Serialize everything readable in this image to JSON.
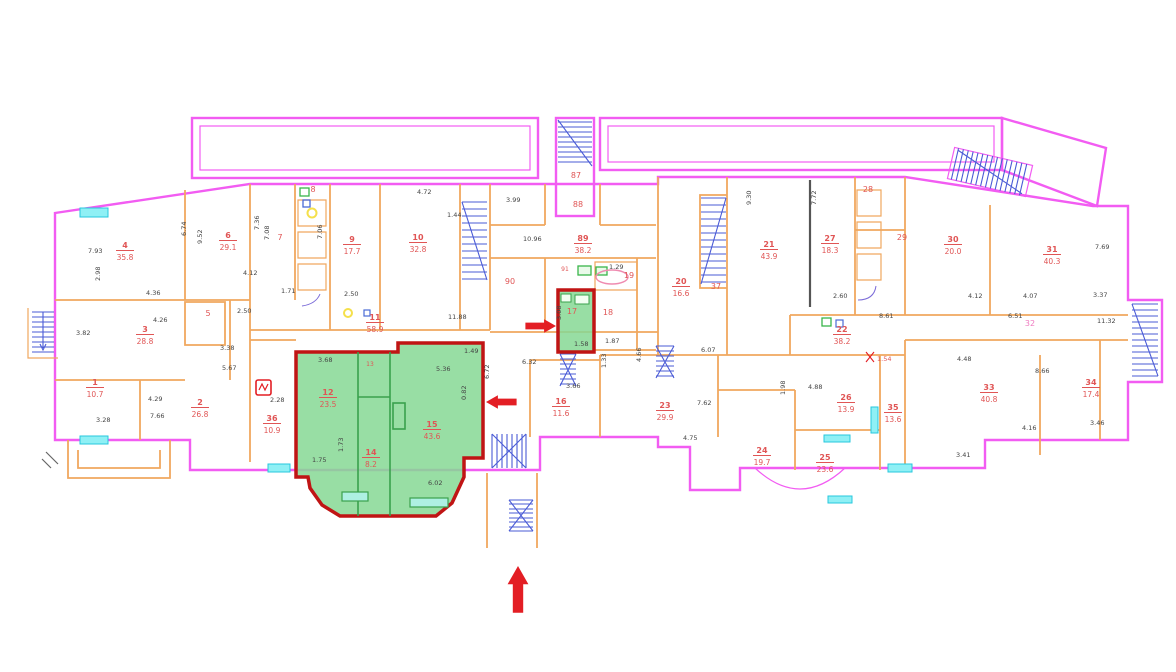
{
  "title": "building-floor-plan",
  "colors": {
    "wall_outer": "#f25cf2",
    "wall_inner": "#f0a85f",
    "stair": "#4a5bd6",
    "window": "#8ff0f5",
    "window_border": "#27c7dd",
    "highlight_fill": "#86d894",
    "highlight_border": "#c01414",
    "room_label": "#e05555",
    "corridor_label": "#ef7bc0",
    "dim_text": "#444444",
    "arrow": "#e31e24",
    "black_wall": "#555555",
    "fixture_green": "#39b54a",
    "fixture_yellow": "#f5e04b",
    "fixture_blue": "#4a6bd6",
    "bath_pink": "#ef8bb0"
  },
  "highlights": {
    "large_unit_rooms": [
      "12",
      "14",
      "15"
    ],
    "small_unit_room": "17"
  },
  "rooms": [
    {
      "num": "1",
      "area": "10.7",
      "x": 95,
      "y": 385
    },
    {
      "num": "2",
      "area": "26.8",
      "x": 200,
      "y": 405
    },
    {
      "num": "3",
      "area": "28.8",
      "x": 145,
      "y": 332
    },
    {
      "num": "4",
      "area": "35.8",
      "x": 125,
      "y": 248
    },
    {
      "num": "6",
      "area": "29.1",
      "x": 228,
      "y": 238
    },
    {
      "num": "9",
      "area": "17.7",
      "x": 352,
      "y": 242
    },
    {
      "num": "10",
      "area": "32.8",
      "x": 418,
      "y": 240
    },
    {
      "num": "11",
      "area": "58.9",
      "x": 375,
      "y": 320
    },
    {
      "num": "12",
      "area": "23.5",
      "x": 328,
      "y": 395
    },
    {
      "num": "14",
      "area": "8.2",
      "x": 371,
      "y": 455
    },
    {
      "num": "15",
      "area": "43.6",
      "x": 432,
      "y": 427
    },
    {
      "num": "16",
      "area": "11.6",
      "x": 561,
      "y": 404
    },
    {
      "num": "20",
      "area": "16.6",
      "x": 681,
      "y": 284
    },
    {
      "num": "21",
      "area": "43.9",
      "x": 769,
      "y": 247
    },
    {
      "num": "22",
      "area": "38.2",
      "x": 842,
      "y": 332
    },
    {
      "num": "23",
      "area": "29.9",
      "x": 665,
      "y": 408
    },
    {
      "num": "24",
      "area": "19.7",
      "x": 762,
      "y": 453
    },
    {
      "num": "25",
      "area": "23.6",
      "x": 825,
      "y": 460
    },
    {
      "num": "26",
      "area": "13.9",
      "x": 846,
      "y": 400
    },
    {
      "num": "27",
      "area": "18.3",
      "x": 830,
      "y": 241
    },
    {
      "num": "30",
      "area": "20.0",
      "x": 953,
      "y": 242
    },
    {
      "num": "31",
      "area": "40.3",
      "x": 1052,
      "y": 252
    },
    {
      "num": "33",
      "area": "40.8",
      "x": 989,
      "y": 390
    },
    {
      "num": "34",
      "area": "17.4",
      "x": 1091,
      "y": 385
    },
    {
      "num": "35",
      "area": "13.6",
      "x": 893,
      "y": 410
    },
    {
      "num": "36",
      "area": "10.9",
      "x": 272,
      "y": 421
    },
    {
      "num": "89",
      "area": "38.2",
      "x": 583,
      "y": 241
    }
  ],
  "labels": [
    {
      "t": "5",
      "x": 208,
      "y": 316
    },
    {
      "t": "7",
      "x": 280,
      "y": 240
    },
    {
      "t": "8",
      "x": 313,
      "y": 192
    },
    {
      "t": "13",
      "x": 370,
      "y": 366,
      "c": "small"
    },
    {
      "t": "17",
      "x": 572,
      "y": 314
    },
    {
      "t": "18",
      "x": 608,
      "y": 315
    },
    {
      "t": "19",
      "x": 629,
      "y": 278
    },
    {
      "t": "28",
      "x": 868,
      "y": 192
    },
    {
      "t": "29",
      "x": 902,
      "y": 240
    },
    {
      "t": "37",
      "x": 716,
      "y": 289
    },
    {
      "t": "87",
      "x": 576,
      "y": 178
    },
    {
      "t": "88",
      "x": 578,
      "y": 207
    },
    {
      "t": "90",
      "x": 510,
      "y": 284
    },
    {
      "t": "91",
      "x": 565,
      "y": 271,
      "c": "small"
    },
    {
      "t": "32",
      "x": 1030,
      "y": 326,
      "c": "pink"
    }
  ],
  "dimensions": [
    {
      "t": "7.93",
      "x": 88,
      "y": 253
    },
    {
      "t": "2.98",
      "x": 100,
      "y": 281,
      "v": true
    },
    {
      "t": "6.74",
      "x": 186,
      "y": 236,
      "v": true
    },
    {
      "t": "9.52",
      "x": 202,
      "y": 244,
      "v": true
    },
    {
      "t": "4.36",
      "x": 146,
      "y": 295
    },
    {
      "t": "4.26",
      "x": 153,
      "y": 322
    },
    {
      "t": "3.82",
      "x": 76,
      "y": 335
    },
    {
      "t": "4.12",
      "x": 243,
      "y": 275
    },
    {
      "t": "1.71",
      "x": 281,
      "y": 293
    },
    {
      "t": "2.50",
      "x": 237,
      "y": 313
    },
    {
      "t": "3.38",
      "x": 220,
      "y": 350
    },
    {
      "t": "5.67",
      "x": 222,
      "y": 370
    },
    {
      "t": "4.29",
      "x": 148,
      "y": 401
    },
    {
      "t": "7.66",
      "x": 150,
      "y": 418
    },
    {
      "t": "2.28",
      "x": 270,
      "y": 402
    },
    {
      "t": "3.28",
      "x": 96,
      "y": 422
    },
    {
      "t": "7.36",
      "x": 259,
      "y": 230,
      "v": true
    },
    {
      "t": "7.08",
      "x": 269,
      "y": 240,
      "v": true
    },
    {
      "t": "7.06",
      "x": 322,
      "y": 239,
      "v": true
    },
    {
      "t": "4.72",
      "x": 417,
      "y": 194
    },
    {
      "t": "2.50",
      "x": 344,
      "y": 296
    },
    {
      "t": "11.88",
      "x": 448,
      "y": 319
    },
    {
      "t": "3.99",
      "x": 506,
      "y": 202
    },
    {
      "t": "1.44",
      "x": 447,
      "y": 217
    },
    {
      "t": "10.96",
      "x": 523,
      "y": 241
    },
    {
      "t": "1.29",
      "x": 609,
      "y": 269
    },
    {
      "t": "3.68",
      "x": 318,
      "y": 362
    },
    {
      "t": "5.36",
      "x": 436,
      "y": 371
    },
    {
      "t": "1.49",
      "x": 464,
      "y": 353
    },
    {
      "t": "6.72",
      "x": 489,
      "y": 379,
      "v": true
    },
    {
      "t": "0.82",
      "x": 466,
      "y": 400,
      "v": true
    },
    {
      "t": "6.02",
      "x": 428,
      "y": 485
    },
    {
      "t": "1.75",
      "x": 312,
      "y": 462
    },
    {
      "t": "1.73",
      "x": 343,
      "y": 452,
      "v": true
    },
    {
      "t": "3.08",
      "x": 561,
      "y": 320,
      "v": true
    },
    {
      "t": "1.58",
      "x": 574,
      "y": 346
    },
    {
      "t": "1.87",
      "x": 605,
      "y": 343
    },
    {
      "t": "6.32",
      "x": 522,
      "y": 364
    },
    {
      "t": "3.66",
      "x": 566,
      "y": 388
    },
    {
      "t": "1.33",
      "x": 606,
      "y": 368,
      "v": true
    },
    {
      "t": "4.66",
      "x": 641,
      "y": 362,
      "v": true
    },
    {
      "t": "6.07",
      "x": 701,
      "y": 352
    },
    {
      "t": "7.62",
      "x": 697,
      "y": 405
    },
    {
      "t": "4.75",
      "x": 683,
      "y": 440
    },
    {
      "t": "9.30",
      "x": 751,
      "y": 205,
      "v": true
    },
    {
      "t": "7.72",
      "x": 816,
      "y": 205,
      "v": true
    },
    {
      "t": "2.60",
      "x": 833,
      "y": 298
    },
    {
      "t": "8.61",
      "x": 879,
      "y": 318
    },
    {
      "t": "6.51",
      "x": 1008,
      "y": 318
    },
    {
      "t": "4.88",
      "x": 808,
      "y": 389
    },
    {
      "t": "1.98",
      "x": 785,
      "y": 395,
      "v": true
    },
    {
      "t": "1.54",
      "x": 877,
      "y": 361,
      "c": "red"
    },
    {
      "t": "4.12",
      "x": 968,
      "y": 298
    },
    {
      "t": "4.07",
      "x": 1023,
      "y": 298
    },
    {
      "t": "3.37",
      "x": 1093,
      "y": 297
    },
    {
      "t": "7.69",
      "x": 1095,
      "y": 249
    },
    {
      "t": "11.32",
      "x": 1097,
      "y": 323
    },
    {
      "t": "4.48",
      "x": 957,
      "y": 361
    },
    {
      "t": "8.66",
      "x": 1035,
      "y": 373
    },
    {
      "t": "4.16",
      "x": 1022,
      "y": 430
    },
    {
      "t": "3.41",
      "x": 956,
      "y": 457
    },
    {
      "t": "3.46",
      "x": 1090,
      "y": 425
    }
  ],
  "arrows": [
    {
      "name": "arrow-into-unit-17",
      "dir": "right",
      "x": 556,
      "y": 326,
      "scale": 0.85
    },
    {
      "name": "arrow-into-apartment",
      "dir": "left",
      "x": 486,
      "y": 402,
      "scale": 0.85
    },
    {
      "name": "main-entrance-arrow",
      "dir": "up",
      "x": 518,
      "y": 566,
      "scale": 1.3
    }
  ]
}
